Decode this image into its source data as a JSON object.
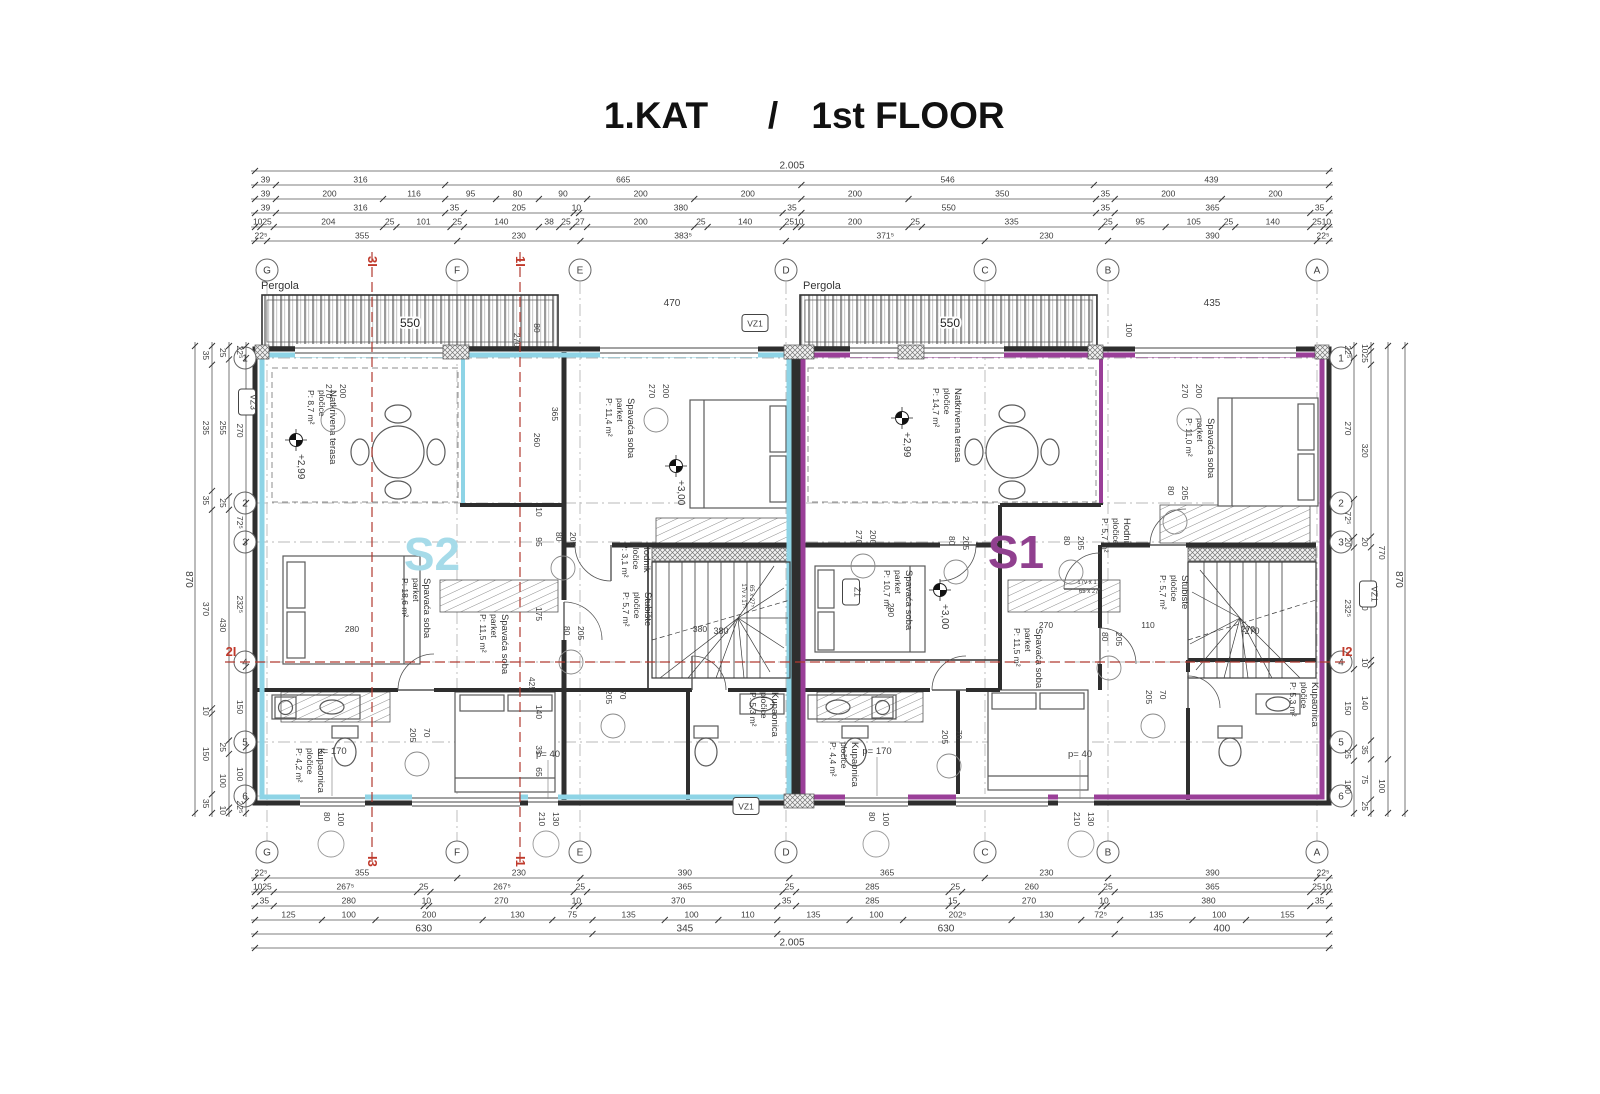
{
  "title": {
    "hr": "1.KAT",
    "sep": "/",
    "en": "1st FLOOR"
  },
  "units": {
    "s2": {
      "label": "S2",
      "color": "#a6dbe9",
      "wall_color": "#8ed4e6",
      "x": 432,
      "y": 570
    },
    "s1": {
      "label": "S1",
      "color": "#90408f",
      "wall_color": "#9a3f98",
      "x": 1016,
      "y": 568
    }
  },
  "pergola": {
    "label": "Pergola",
    "dim": "550"
  },
  "grid": {
    "cols": [
      {
        "l": "G",
        "x": 267
      },
      {
        "l": "F",
        "x": 457
      },
      {
        "l": "E",
        "x": 580
      },
      {
        "l": "D",
        "x": 786
      },
      {
        "l": "C",
        "x": 985
      },
      {
        "l": "B",
        "x": 1108
      },
      {
        "l": "A",
        "x": 1317
      }
    ],
    "rows": [
      {
        "l": "1",
        "y": 358
      },
      {
        "l": "2",
        "y": 503
      },
      {
        "l": "3",
        "y": 542
      },
      {
        "l": "4",
        "y": 662
      },
      {
        "l": "5",
        "y": 742
      },
      {
        "l": "6",
        "y": 796
      }
    ]
  },
  "rooms": {
    "s2_terrace": {
      "name": "Natkrivena terasa",
      "floor": "pločice",
      "area": "P: 8,7 m²",
      "x": 330,
      "y": 390
    },
    "s2_bedroom_a": {
      "name": "Spavaća soba",
      "floor": "parket",
      "area": "P: 11,4 m²",
      "x": 628,
      "y": 398
    },
    "s2_bedroom_b": {
      "name": "Spavaća soba",
      "floor": "parket",
      "area": "P: 18,6 m²",
      "x": 424,
      "y": 578
    },
    "s2_bedroom_c": {
      "name": "Spavaća soba",
      "floor": "parket",
      "area": "P: 11,5 m²",
      "x": 502,
      "y": 614
    },
    "s2_hall": {
      "name": "Hodnik",
      "floor": "pločice",
      "area": "P: 3,1 m²",
      "x": 644,
      "y": 543
    },
    "s2_stairs": {
      "name": "Stubište",
      "floor": "pločice",
      "area": "P: 5,7 m²",
      "x": 645,
      "y": 592
    },
    "s2_bath_a": {
      "name": "Kupaonica",
      "floor": "pločice",
      "area": "P: 4,2 m²",
      "x": 318,
      "y": 748
    },
    "s2_bath_b": {
      "name": "Kupaonica",
      "floor": "pločice",
      "area": "P: 5,3 m²",
      "x": 772,
      "y": 692
    },
    "s1_terrace": {
      "name": "Natkrivena terasa",
      "floor": "pločice",
      "area": "P: 14,7 m²",
      "x": 955,
      "y": 388
    },
    "s1_bedroom_a": {
      "name": "Spavaća soba",
      "floor": "parket",
      "area": "P: 10,7 m²",
      "x": 906,
      "y": 570
    },
    "s1_bedroom_b": {
      "name": "Spavaća soba",
      "floor": "parket",
      "area": "P: 11,5 m²",
      "x": 1036,
      "y": 628
    },
    "s1_bedroom_c": {
      "name": "Spavaća soba",
      "floor": "parket",
      "area": "P: 11,0 m²",
      "x": 1208,
      "y": 418
    },
    "s1_hall": {
      "name": "Hodnik",
      "floor": "pločice",
      "area": "P: 5,7 m²",
      "x": 1124,
      "y": 518
    },
    "s1_stairs": {
      "name": "Stubište",
      "floor": "pločice",
      "area": "P: 5,7 m²",
      "x": 1182,
      "y": 575
    },
    "s1_bath_a": {
      "name": "Kupaonica",
      "floor": "pločice",
      "area": "P: 4,4 m²",
      "x": 852,
      "y": 742
    },
    "s1_bath_b": {
      "name": "Kupaonica",
      "floor": "pločice",
      "area": "P: 5,3 m²",
      "x": 1312,
      "y": 682
    }
  },
  "elevations": [
    {
      "t": "+2,99",
      "x": 296,
      "y": 440
    },
    {
      "t": "+3,00",
      "x": 676,
      "y": 466
    },
    {
      "t": "+2,99",
      "x": 902,
      "y": 418
    },
    {
      "t": "+3,00",
      "x": 940,
      "y": 590
    }
  ],
  "boxes": [
    {
      "t": "VZ3",
      "x": 247,
      "y": 402,
      "r": 1
    },
    {
      "t": "VZ1",
      "x": 755,
      "y": 323,
      "r": 0
    },
    {
      "t": "VZ1",
      "x": 746,
      "y": 806,
      "r": 0
    },
    {
      "t": "VZ1",
      "x": 1368,
      "y": 594,
      "r": 1
    },
    {
      "t": "Z1",
      "x": 851,
      "y": 592,
      "r": 1
    }
  ],
  "sections": [
    {
      "type": "v",
      "x": 372,
      "a": "3I",
      "b": "I3"
    },
    {
      "type": "v",
      "x": 520,
      "a": "1I",
      "b": "I1"
    },
    {
      "type": "h",
      "y": 662,
      "a": "2I",
      "b": "I2"
    }
  ],
  "window_tags": [
    {
      "t": "p= 170",
      "x": 332,
      "y": 754
    },
    {
      "t": "p= 40",
      "x": 548,
      "y": 757
    },
    {
      "t": "p= 170",
      "x": 877,
      "y": 754
    },
    {
      "t": "p= 40",
      "x": 1080,
      "y": 757
    }
  ],
  "leaders": [
    {
      "a": "270",
      "b": "200",
      "x": 332,
      "y": 384
    },
    {
      "a": "270",
      "b": "200",
      "x": 655,
      "y": 384
    },
    {
      "a": "270",
      "b": "200",
      "x": 862,
      "y": 530
    },
    {
      "a": "270",
      "b": "200",
      "x": 1188,
      "y": 384
    },
    {
      "a": "80",
      "b": "205",
      "x": 562,
      "y": 532
    },
    {
      "a": "80",
      "b": "205",
      "x": 570,
      "y": 626
    },
    {
      "a": "80",
      "b": "205",
      "x": 955,
      "y": 536
    },
    {
      "a": "80",
      "b": "205",
      "x": 1070,
      "y": 536
    },
    {
      "a": "80",
      "b": "205",
      "x": 1174,
      "y": 486
    },
    {
      "a": "80",
      "b": "205",
      "x": 1108,
      "y": 632
    },
    {
      "a": "205",
      "b": "70",
      "x": 416,
      "y": 728
    },
    {
      "a": "205",
      "b": "70",
      "x": 612,
      "y": 690
    },
    {
      "a": "205",
      "b": "70",
      "x": 948,
      "y": 730
    },
    {
      "a": "205",
      "b": "70",
      "x": 1152,
      "y": 690
    }
  ],
  "bottom_leaders": [
    {
      "a": "80",
      "b": "100",
      "x": 330
    },
    {
      "a": "80",
      "b": "100",
      "x": 875
    },
    {
      "a": "210",
      "b": "130",
      "x": 545
    },
    {
      "a": "210",
      "b": "130",
      "x": 1080
    }
  ],
  "free_dims": [
    {
      "t": "470",
      "x": 672,
      "y": 306,
      "r": 0,
      "fs": 10
    },
    {
      "t": "435",
      "x": 1212,
      "y": 306,
      "r": 0,
      "fs": 10
    },
    {
      "t": "100",
      "x": 1126,
      "y": 330,
      "r": 1
    },
    {
      "t": "270",
      "x": 514,
      "y": 340,
      "r": 1
    },
    {
      "t": "80",
      "x": 534,
      "y": 328,
      "r": 1
    },
    {
      "t": "365",
      "x": 552,
      "y": 414,
      "r": 1
    },
    {
      "t": "260",
      "x": 534,
      "y": 440,
      "r": 1
    },
    {
      "t": "280",
      "x": 352,
      "y": 632,
      "r": 0
    },
    {
      "t": "380",
      "x": 700,
      "y": 632,
      "r": 0
    },
    {
      "t": "270",
      "x": 1248,
      "y": 632,
      "r": 0
    },
    {
      "t": "110",
      "x": 1148,
      "y": 628,
      "r": 0
    },
    {
      "t": "270",
      "x": 1046,
      "y": 628,
      "r": 0
    },
    {
      "t": "290",
      "x": 888,
      "y": 610,
      "r": 1
    },
    {
      "t": "10",
      "x": 536,
      "y": 512,
      "r": 1
    },
    {
      "t": "95",
      "x": 536,
      "y": 542,
      "r": 1
    },
    {
      "t": "175",
      "x": 536,
      "y": 614,
      "r": 1
    },
    {
      "t": "425",
      "x": 529,
      "y": 684,
      "r": 1
    },
    {
      "t": "140",
      "x": 536,
      "y": 712,
      "r": 1
    },
    {
      "t": "35",
      "x": 536,
      "y": 750,
      "r": 1
    },
    {
      "t": "65",
      "x": 536,
      "y": 772,
      "r": 1
    },
    {
      "t": "17v x 17⁵",
      "x": 742,
      "y": 596,
      "r": 1,
      "fs": 6
    },
    {
      "t": "65 x 27⁵",
      "x": 750,
      "y": 596,
      "r": 1,
      "fs": 6
    },
    {
      "t": "17v x 17⁵",
      "x": 1090,
      "y": 584,
      "r": 0,
      "fs": 6
    },
    {
      "t": "65 x 27⁵",
      "x": 1090,
      "y": 593,
      "r": 0,
      "fs": 6
    }
  ],
  "chains": [
    {
      "o": "h",
      "pos": 171,
      "from": 255,
      "to": 1329,
      "v": [
        "2.005"
      ],
      "fs": 10
    },
    {
      "o": "h",
      "pos": 185,
      "from": 255,
      "to": 1329,
      "v": [
        "39",
        "316",
        "665",
        "546",
        "439"
      ]
    },
    {
      "o": "h",
      "pos": 199,
      "from": 255,
      "to": 1329,
      "v": [
        "39",
        "200",
        "116",
        "95",
        "80",
        "90",
        "200",
        "200",
        "200",
        "350",
        "35",
        "200",
        "200"
      ]
    },
    {
      "o": "h",
      "pos": 213,
      "from": 255,
      "to": 1329,
      "v": [
        "39",
        "316",
        "35",
        "205",
        "10",
        "380",
        "35",
        "550",
        "35",
        "365",
        "35"
      ]
    },
    {
      "o": "h",
      "pos": 227,
      "from": 255,
      "to": 1329,
      "v": [
        "10",
        "25",
        "204",
        "25",
        "101",
        "25",
        "140",
        "38",
        "25",
        "27",
        "200",
        "25",
        "140",
        "25",
        "10",
        "200",
        "25",
        "335",
        "25",
        "95",
        "105",
        "25",
        "140",
        "25",
        "10"
      ]
    },
    {
      "o": "h",
      "pos": 241,
      "from": 255,
      "to": 1329,
      "v": [
        "22⁵",
        "355",
        "230",
        "383⁵",
        "371⁵",
        "230",
        "390",
        "22⁵"
      ]
    },
    {
      "o": "h",
      "pos": 878,
      "from": 255,
      "to": 1329,
      "v": [
        "22⁵",
        "355",
        "230",
        "390",
        "365",
        "230",
        "390",
        "22⁵"
      ]
    },
    {
      "o": "h",
      "pos": 892,
      "from": 255,
      "to": 1329,
      "v": [
        "10",
        "25",
        "267⁵",
        "25",
        "267⁵",
        "25",
        "365",
        "25",
        "285",
        "25",
        "260",
        "25",
        "365",
        "25",
        "10"
      ]
    },
    {
      "o": "h",
      "pos": 906,
      "from": 255,
      "to": 1329,
      "v": [
        "35",
        "280",
        "10",
        "270",
        "10",
        "370",
        "35",
        "285",
        "15",
        "270",
        "10",
        "380",
        "35"
      ]
    },
    {
      "o": "h",
      "pos": 920,
      "from": 255,
      "to": 1329,
      "v": [
        "125",
        "100",
        "200",
        "130",
        "75",
        "135",
        "100",
        "110",
        "135",
        "100",
        "202⁵",
        "130",
        "72⁵",
        "135",
        "100",
        "155"
      ]
    },
    {
      "o": "h",
      "pos": 934,
      "from": 255,
      "to": 1329,
      "v": [
        "630",
        "345",
        "630",
        "400"
      ],
      "fs": 10
    },
    {
      "o": "h",
      "pos": 948,
      "from": 255,
      "to": 1329,
      "v": [
        "2.005"
      ],
      "fs": 10
    },
    {
      "o": "v",
      "pos": 246,
      "from": 346,
      "to": 813,
      "v": [
        "22⁵",
        "270",
        "72⁵",
        "232⁵",
        "150",
        "100",
        "22⁵"
      ]
    },
    {
      "o": "v",
      "pos": 229,
      "from": 346,
      "to": 813,
      "v": [
        "25",
        "255",
        "25",
        "430",
        "25",
        "100",
        "10"
      ]
    },
    {
      "o": "v",
      "pos": 212,
      "from": 346,
      "to": 813,
      "v": [
        "35",
        "235",
        "35",
        "370",
        "10",
        "150",
        "35"
      ]
    },
    {
      "o": "v",
      "pos": 195,
      "from": 346,
      "to": 813,
      "v": [
        "870"
      ],
      "fs": 10
    },
    {
      "o": "v",
      "pos": 1354,
      "from": 346,
      "to": 813,
      "v": [
        "22⁵",
        "270",
        "72⁵",
        "20",
        "232⁵",
        "150",
        "25",
        "100"
      ]
    },
    {
      "o": "v",
      "pos": 1371,
      "from": 346,
      "to": 813,
      "v": [
        "10",
        "25",
        "320",
        "20",
        "210",
        "10",
        "140",
        "35",
        "75",
        "25"
      ]
    },
    {
      "o": "v",
      "pos": 1388,
      "from": 346,
      "to": 813,
      "v": [
        "770",
        "100"
      ]
    },
    {
      "o": "v",
      "pos": 1405,
      "from": 346,
      "to": 813,
      "v": [
        "870"
      ],
      "fs": 10
    }
  ],
  "stairs": {
    "s2_width": "380",
    "s1_width": "270"
  }
}
